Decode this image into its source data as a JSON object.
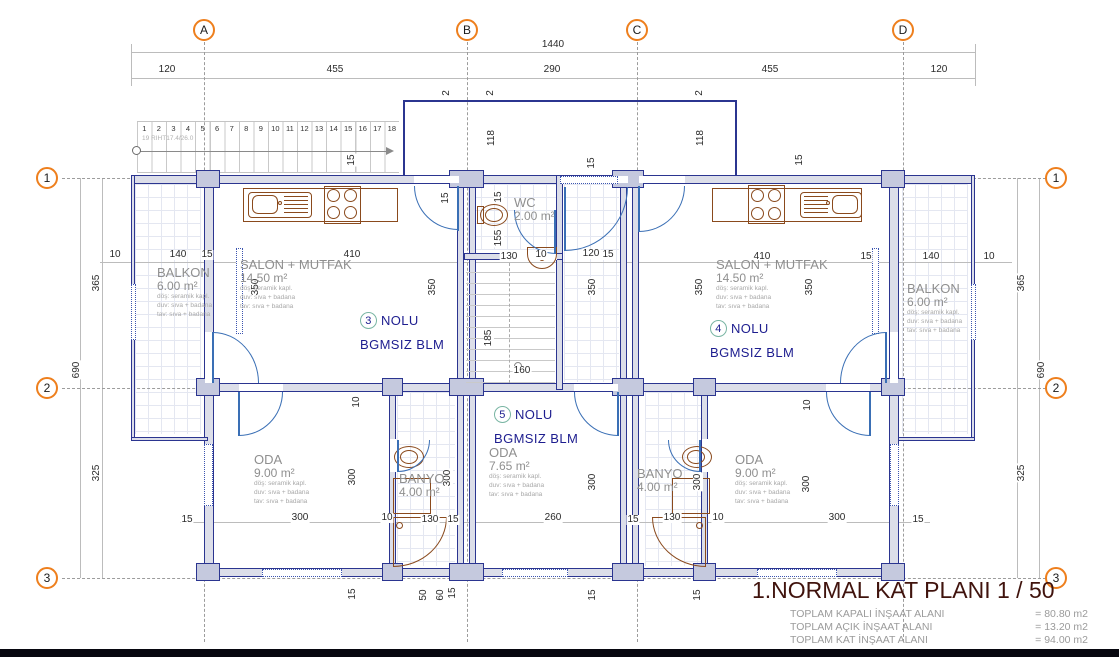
{
  "grid": {
    "cols": [
      {
        "label": "A",
        "x": 204
      },
      {
        "label": "B",
        "x": 467
      },
      {
        "label": "C",
        "x": 637
      },
      {
        "label": "D",
        "x": 903
      }
    ],
    "rows": [
      {
        "label": "1",
        "y": 178
      },
      {
        "label": "2",
        "y": 388
      },
      {
        "label": "3",
        "y": 578
      }
    ]
  },
  "dimensions": [
    {
      "t": "1440",
      "x": 553,
      "y": 45
    },
    {
      "t": "120",
      "x": 167,
      "y": 70
    },
    {
      "t": "455",
      "x": 335,
      "y": 70
    },
    {
      "t": "290",
      "x": 552,
      "y": 70
    },
    {
      "t": "455",
      "x": 770,
      "y": 70
    },
    {
      "t": "120",
      "x": 939,
      "y": 70
    },
    {
      "t": "2",
      "x": 447,
      "y": 93,
      "r": 1
    },
    {
      "t": "2",
      "x": 491,
      "y": 93,
      "r": 1
    },
    {
      "t": "2",
      "x": 700,
      "y": 93,
      "r": 1
    },
    {
      "t": "118",
      "x": 492,
      "y": 138,
      "r": 1
    },
    {
      "t": "118",
      "x": 701,
      "y": 138,
      "r": 1
    },
    {
      "t": "15",
      "x": 352,
      "y": 160,
      "r": 1
    },
    {
      "t": "15",
      "x": 592,
      "y": 163,
      "r": 1
    },
    {
      "t": "15",
      "x": 800,
      "y": 160,
      "r": 1
    },
    {
      "t": "365",
      "x": 97,
      "y": 283,
      "r": 1
    },
    {
      "t": "690",
      "x": 77,
      "y": 370,
      "r": 1
    },
    {
      "t": "325",
      "x": 97,
      "y": 473,
      "r": 1
    },
    {
      "t": "365",
      "x": 1022,
      "y": 283,
      "r": 1
    },
    {
      "t": "690",
      "x": 1042,
      "y": 370,
      "r": 1
    },
    {
      "t": "325",
      "x": 1022,
      "y": 473,
      "r": 1
    },
    {
      "t": "10",
      "x": 115,
      "y": 255
    },
    {
      "t": "140",
      "x": 178,
      "y": 255
    },
    {
      "t": "15",
      "x": 207,
      "y": 255
    },
    {
      "t": "410",
      "x": 352,
      "y": 255
    },
    {
      "t": "410",
      "x": 762,
      "y": 257
    },
    {
      "t": "15",
      "x": 866,
      "y": 257
    },
    {
      "t": "140",
      "x": 931,
      "y": 257
    },
    {
      "t": "10",
      "x": 989,
      "y": 257
    },
    {
      "t": "15",
      "x": 499,
      "y": 197,
      "r": 1
    },
    {
      "t": "155",
      "x": 499,
      "y": 238,
      "r": 1
    },
    {
      "t": "130",
      "x": 509,
      "y": 257
    },
    {
      "t": "10",
      "x": 541,
      "y": 255
    },
    {
      "t": "120",
      "x": 591,
      "y": 254
    },
    {
      "t": "15",
      "x": 608,
      "y": 255
    },
    {
      "t": "15",
      "x": 446,
      "y": 198,
      "r": 1
    },
    {
      "t": "350",
      "x": 256,
      "y": 287,
      "r": 1
    },
    {
      "t": "350",
      "x": 433,
      "y": 287,
      "r": 1
    },
    {
      "t": "350",
      "x": 593,
      "y": 287,
      "r": 1
    },
    {
      "t": "350",
      "x": 700,
      "y": 287,
      "r": 1
    },
    {
      "t": "350",
      "x": 810,
      "y": 287,
      "r": 1
    },
    {
      "t": "185",
      "x": 489,
      "y": 338,
      "r": 1
    },
    {
      "t": "160",
      "x": 522,
      "y": 371
    },
    {
      "t": "10",
      "x": 357,
      "y": 402,
      "r": 1
    },
    {
      "t": "10",
      "x": 808,
      "y": 405,
      "r": 1
    },
    {
      "t": "300",
      "x": 353,
      "y": 477,
      "r": 1
    },
    {
      "t": "300",
      "x": 448,
      "y": 478,
      "r": 1
    },
    {
      "t": "300",
      "x": 593,
      "y": 482,
      "r": 1
    },
    {
      "t": "300",
      "x": 698,
      "y": 482,
      "r": 1
    },
    {
      "t": "300",
      "x": 807,
      "y": 484,
      "r": 1
    },
    {
      "t": "15",
      "x": 187,
      "y": 520
    },
    {
      "t": "300",
      "x": 300,
      "y": 518
    },
    {
      "t": "10",
      "x": 387,
      "y": 518
    },
    {
      "t": "130",
      "x": 430,
      "y": 520
    },
    {
      "t": "15",
      "x": 453,
      "y": 520
    },
    {
      "t": "260",
      "x": 553,
      "y": 518
    },
    {
      "t": "15",
      "x": 633,
      "y": 520
    },
    {
      "t": "130",
      "x": 672,
      "y": 518
    },
    {
      "t": "10",
      "x": 718,
      "y": 518
    },
    {
      "t": "300",
      "x": 837,
      "y": 518
    },
    {
      "t": "15",
      "x": 918,
      "y": 520
    },
    {
      "t": "15",
      "x": 353,
      "y": 594,
      "r": 1
    },
    {
      "t": "50",
      "x": 424,
      "y": 595,
      "r": 1
    },
    {
      "t": "60",
      "x": 441,
      "y": 595,
      "r": 1
    },
    {
      "t": "15",
      "x": 453,
      "y": 593,
      "r": 1
    },
    {
      "t": "15",
      "x": 593,
      "y": 595,
      "r": 1
    },
    {
      "t": "15",
      "x": 698,
      "y": 595,
      "r": 1
    }
  ],
  "rooms": [
    {
      "id": "balkon-left",
      "name": "BALKON",
      "area": "6.00 m²",
      "x": 157,
      "y": 266,
      "finishes": [
        "döş: seramik kapl.",
        "duv: sıva + badana",
        "tav: sıva + badana"
      ]
    },
    {
      "id": "salon-left",
      "name": "SALON + MUTFAK",
      "area": "14.50 m²",
      "x": 240,
      "y": 258,
      "finishes": [
        "döş: seramik kapl.",
        "duv: sıva + badana",
        "tav: sıva + badana"
      ]
    },
    {
      "id": "wc",
      "name": "WC",
      "area": "2.00 m²",
      "x": 514,
      "y": 196,
      "finishes": []
    },
    {
      "id": "salon-right",
      "name": "SALON + MUTFAK",
      "area": "14.50 m²",
      "x": 716,
      "y": 258,
      "finishes": [
        "döş: seramik kapl.",
        "duv: sıva + badana",
        "tav: sıva + badana"
      ]
    },
    {
      "id": "balkon-right",
      "name": "BALKON",
      "area": "6.00 m²",
      "x": 907,
      "y": 282,
      "finishes": [
        "döş: seramik kapl.",
        "duv: sıva + badana",
        "tav: sıva + badana"
      ]
    },
    {
      "id": "oda-left",
      "name": "ODA",
      "area": "9.00 m²",
      "x": 254,
      "y": 453,
      "finishes": [
        "döş: seramik kapl.",
        "duv: sıva + badana",
        "tav: sıva + badana"
      ]
    },
    {
      "id": "banyo-left",
      "name": "BANYO",
      "area": "4.00 m²",
      "x": 399,
      "y": 472,
      "finishes": []
    },
    {
      "id": "oda-center",
      "name": "ODA",
      "area": "7.65 m²",
      "x": 489,
      "y": 446,
      "finishes": [
        "döş: seramik kapl.",
        "duv: sıva + badana",
        "tav: sıva + badana"
      ]
    },
    {
      "id": "banyo-right",
      "name": "BANYO",
      "area": "4.00 m²",
      "x": 637,
      "y": 467,
      "finishes": []
    },
    {
      "id": "oda-right",
      "name": "ODA",
      "area": "9.00 m²",
      "x": 735,
      "y": 453,
      "finishes": [
        "döş: seramik kapl.",
        "duv: sıva + badana",
        "tav: sıva + badana"
      ]
    }
  ],
  "units": [
    {
      "num": "3",
      "label": "NOLU",
      "sub": "BGMSIZ BLM",
      "x": 360,
      "y": 312
    },
    {
      "num": "4",
      "label": "NOLU",
      "sub": "BGMSIZ BLM",
      "x": 710,
      "y": 320
    },
    {
      "num": "5",
      "label": "NOLU",
      "sub": "BGMSIZ BLM",
      "x": 494,
      "y": 406
    }
  ],
  "stairs": {
    "treads": [
      "1",
      "2",
      "3",
      "4",
      "5",
      "6",
      "7",
      "8",
      "9",
      "10",
      "11",
      "12",
      "13",
      "14",
      "15",
      "16",
      "17",
      "18"
    ],
    "note": "19 RIHT17.4/26.0"
  },
  "title_block": {
    "title": "1.NORMAL KAT PLANI 1 / 50",
    "totals": [
      {
        "label": "TOPLAM KAPALI İNŞAAT ALANI",
        "value": "= 80.80 m2"
      },
      {
        "label": "TOPLAM AÇIK İNŞAAT ALANI",
        "value": "= 13.20 m2"
      },
      {
        "label": "TOPLAM KAT İNŞAAT ALANI",
        "value": "= 94.00 m2"
      }
    ]
  },
  "colors": {
    "wall": "#2b3590",
    "wall_fill": "#dcdee9",
    "grid_bubble": "#ee7f1d",
    "door": "#3a6fb5",
    "fixture": "#8a4a1d",
    "unit_text": "#1d1d8f",
    "unit_circle": "#79b5a3",
    "title": "#40130d",
    "totals": "#9b9b9b"
  }
}
